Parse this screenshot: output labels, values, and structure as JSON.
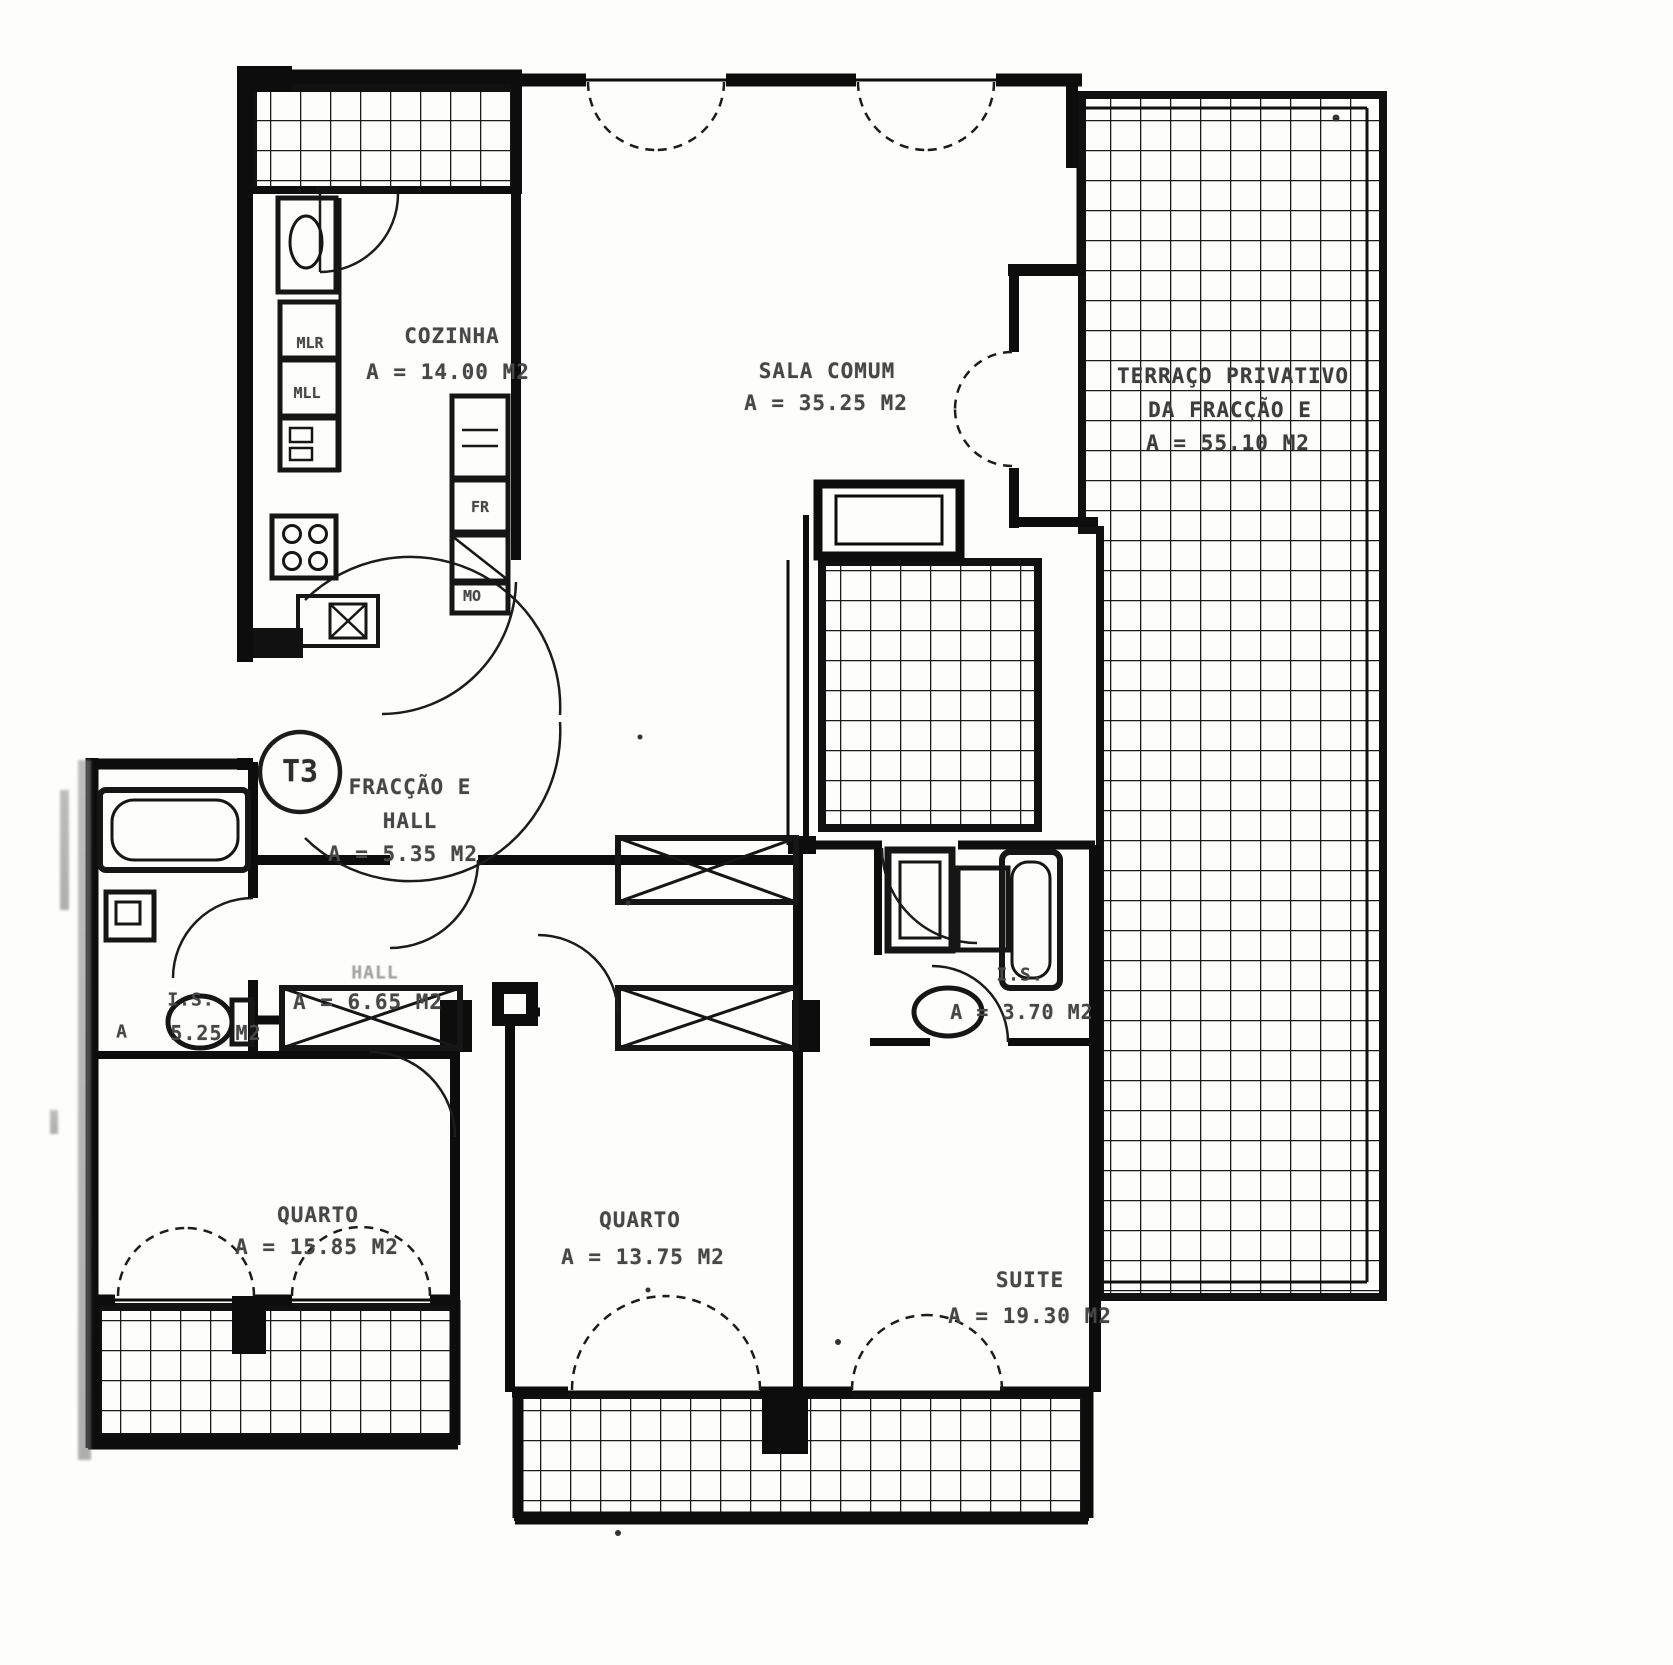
{
  "plan": {
    "unit_badge": "T3",
    "rooms": {
      "cozinha": {
        "name": "COZINHA",
        "area": "A = 14.00 M2"
      },
      "sala_comum": {
        "name": "SALA COMUM",
        "area": "A = 35.25 M2"
      },
      "terraco": {
        "name_line1": "TERRAÇO PRIVATIVO",
        "name_line2": "DA FRACÇÃO E",
        "area": "A = 55.10 M2"
      },
      "fraccao_hall": {
        "name_line1": "FRACÇÃO E",
        "name_line2": "HALL",
        "area": "A = 5.35 M2"
      },
      "hall": {
        "name": "HALL",
        "area": "A = 6.65 M2"
      },
      "is_esquerda": {
        "name": "I.S.",
        "area_prefix": "A",
        "area": "5.25 M2"
      },
      "is_suite": {
        "name": "I.S.",
        "area": "A = 3.70 M2"
      },
      "quarto_1": {
        "name": "QUARTO",
        "area": "A = 15.85 M2"
      },
      "quarto_2": {
        "name": "QUARTO",
        "area": "A = 13.75 M2"
      },
      "suite": {
        "name": "SUITE",
        "area": "A = 19.30 M2"
      }
    },
    "kitchen_labels": {
      "mlr": "MLR",
      "mll": "MLL",
      "fr": "FR",
      "mo": "MO"
    },
    "colors": {
      "ink": "#111111",
      "text": "#474747",
      "paper": "#fdfdfc"
    }
  }
}
